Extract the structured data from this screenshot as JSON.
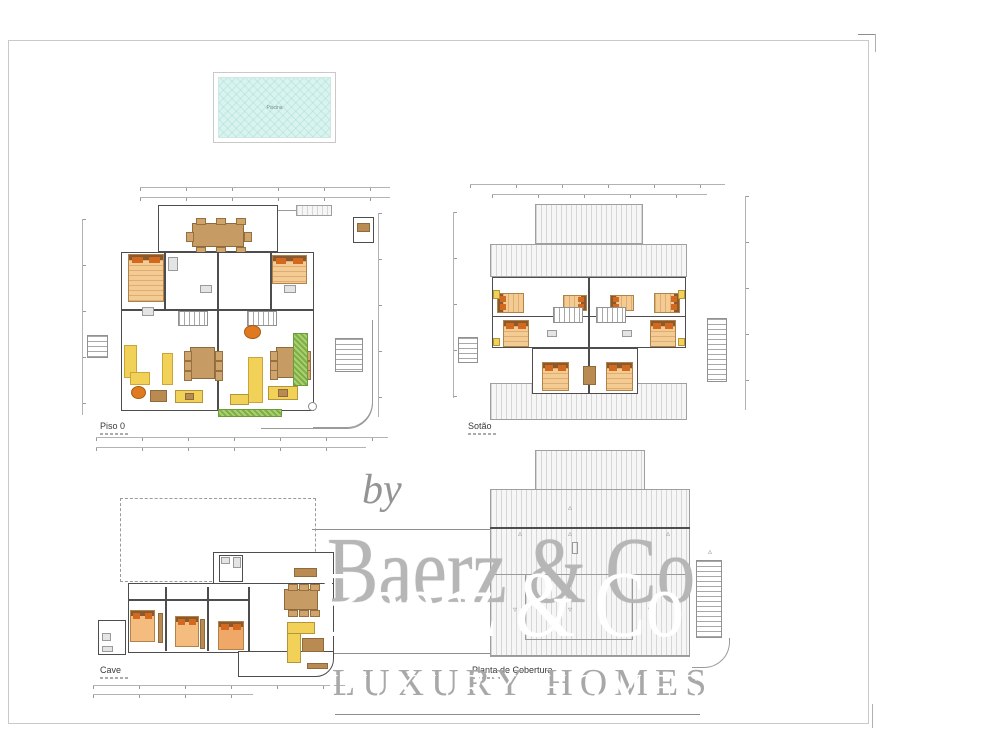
{
  "watermark": {
    "by": "by",
    "brand": "Baerz & Co",
    "tagline": "LUXURY HOMES"
  },
  "pool": {
    "label": "Piscina",
    "water_color": "#d9f3ef"
  },
  "colors": {
    "wall": "#4d4d4d",
    "dim": "#b3b3b3",
    "bed": "#f4cb92",
    "pillow": "#d2691e",
    "sofa": "#f2d159",
    "wood": "#c79c64",
    "hedge": "#8ab54f",
    "roof_hatch": "#d6d6d6"
  },
  "plans": [
    {
      "id": "piso0",
      "label": "Piso 0",
      "x": 80,
      "y": 183,
      "w": 312,
      "h": 276,
      "lx": 20,
      "ly": 238,
      "items": [
        [
          "dim-h",
          60,
          4,
          250,
          4
        ],
        [
          "dim-h",
          60,
          14,
          250,
          4
        ],
        [
          "dim-v",
          2,
          36,
          4,
          196
        ],
        [
          "dim-v",
          298,
          30,
          4,
          204
        ],
        [
          "dim-h",
          16,
          254,
          292,
          4
        ],
        [
          "dim-h",
          16,
          264,
          270,
          4
        ],
        [
          "wall-rect",
          78,
          22,
          120,
          47
        ],
        [
          "table",
          112,
          40,
          52,
          24,
          {
            "ch": 8
          }
        ],
        [
          "gray-line",
          198,
          27,
          52,
          1
        ],
        [
          "roof",
          216,
          22,
          36,
          11
        ],
        [
          "wall-rect",
          273,
          34,
          21,
          26
        ],
        [
          "wood",
          277,
          40,
          13,
          9
        ],
        [
          "wall-rect",
          41,
          69,
          193,
          159
        ],
        [
          "wall-line",
          137,
          69,
          2,
          159
        ],
        [
          "wall-line",
          41,
          126,
          96,
          2
        ],
        [
          "wall-line",
          139,
          126,
          95,
          2
        ],
        [
          "wall-line",
          84,
          69,
          2,
          57
        ],
        [
          "wall-line",
          190,
          69,
          2,
          57
        ],
        [
          "stair-h",
          98,
          128,
          30,
          15
        ],
        [
          "stair-h",
          167,
          128,
          30,
          15
        ],
        [
          "bed",
          48,
          71,
          36,
          48
        ],
        [
          "bed",
          192,
          72,
          35,
          29
        ],
        [
          "fix",
          88,
          74,
          10,
          14
        ],
        [
          "fix",
          62,
          124,
          12,
          9
        ],
        [
          "fix",
          120,
          102,
          12,
          8
        ],
        [
          "fix",
          204,
          102,
          12,
          8
        ],
        [
          "sofa",
          44,
          162,
          13,
          33
        ],
        [
          "sofa",
          50,
          189,
          20,
          13
        ],
        [
          "sofa",
          82,
          170,
          11,
          32
        ],
        [
          "round",
          51,
          203,
          15,
          13
        ],
        [
          "table",
          110,
          164,
          25,
          32,
          {
            "ch": 6
          }
        ],
        [
          "wood",
          70,
          207,
          17,
          12
        ],
        [
          "counter",
          95,
          207,
          28,
          13
        ],
        [
          "wood",
          105,
          210,
          9,
          7
        ],
        [
          "round",
          164,
          142,
          17,
          14
        ],
        [
          "table",
          196,
          164,
          27,
          31,
          {
            "ch": 6
          }
        ],
        [
          "sofa",
          168,
          174,
          15,
          46
        ],
        [
          "counter",
          150,
          211,
          19,
          11
        ],
        [
          "counter",
          188,
          203,
          30,
          14
        ],
        [
          "wood",
          198,
          206,
          10,
          8
        ],
        [
          "hedge",
          213,
          150,
          15,
          53
        ],
        [
          "hedge",
          138,
          226,
          64,
          8
        ],
        [
          "stair-v",
          255,
          155,
          28,
          34
        ],
        [
          "stair-v",
          7,
          152,
          21,
          23
        ],
        [
          "outline-rbr",
          233,
          137,
          60,
          108
        ],
        [
          "outline-rbr",
          181,
          218,
          112,
          28
        ],
        [
          "circ",
          228,
          219,
          9,
          9
        ]
      ]
    },
    {
      "id": "sotao",
      "label": "Sotão",
      "x": 452,
      "y": 178,
      "w": 300,
      "h": 268,
      "lx": 16,
      "ly": 243,
      "items": [
        [
          "dim-h",
          18,
          6,
          255,
          4
        ],
        [
          "dim-h",
          40,
          16,
          215,
          4
        ],
        [
          "dim-v",
          293,
          18,
          4,
          214
        ],
        [
          "dim-v",
          1,
          34,
          4,
          186
        ],
        [
          "roof",
          83,
          26,
          108,
          40
        ],
        [
          "roof",
          38,
          66,
          197,
          33
        ],
        [
          "roof",
          38,
          205,
          197,
          37
        ],
        [
          "wall-rect",
          40,
          99,
          194,
          71
        ],
        [
          "wall-rect",
          80,
          170,
          106,
          46
        ],
        [
          "wall-line",
          136,
          99,
          2,
          117
        ],
        [
          "wall-line",
          40,
          138,
          194,
          1
        ],
        [
          "bed",
          45,
          115,
          27,
          20,
          {
            "dir": "h"
          }
        ],
        [
          "bed",
          111,
          117,
          24,
          16,
          {
            "dir": "h",
            "hb": "r"
          }
        ],
        [
          "bed",
          158,
          117,
          24,
          16,
          {
            "dir": "h"
          }
        ],
        [
          "bed",
          202,
          115,
          26,
          20,
          {
            "dir": "h",
            "hb": "r"
          }
        ],
        [
          "bed",
          51,
          142,
          26,
          27
        ],
        [
          "bed",
          198,
          142,
          26,
          27
        ],
        [
          "bed",
          90,
          184,
          27,
          29
        ],
        [
          "bed",
          154,
          184,
          27,
          29
        ],
        [
          "wood",
          131,
          188,
          13,
          19
        ],
        [
          "stair-h",
          101,
          129,
          30,
          16
        ],
        [
          "stair-h",
          144,
          129,
          30,
          16
        ],
        [
          "fix",
          95,
          152,
          10,
          7
        ],
        [
          "fix",
          170,
          152,
          10,
          7
        ],
        [
          "counter",
          41,
          112,
          7,
          9
        ],
        [
          "counter",
          226,
          112,
          7,
          9
        ],
        [
          "counter",
          41,
          160,
          7,
          8
        ],
        [
          "counter",
          226,
          160,
          7,
          8
        ],
        [
          "stair-v",
          6,
          159,
          20,
          26
        ],
        [
          "stair-v",
          255,
          140,
          20,
          64
        ]
      ]
    },
    {
      "id": "cave",
      "label": "Cave",
      "x": 88,
      "y": 495,
      "w": 272,
      "h": 210,
      "lx": 12,
      "ly": 170,
      "items": [
        [
          "dash-rect",
          32,
          3,
          196,
          84
        ],
        [
          "wall-rect",
          125,
          57,
          121,
          35
        ],
        [
          "wall-rect",
          40,
          88,
          206,
          70
        ],
        [
          "wall-rbr",
          150,
          156,
          96,
          26
        ],
        [
          "wall-rect",
          10,
          125,
          28,
          35
        ],
        [
          "wall-line",
          77,
          92,
          2,
          64
        ],
        [
          "wall-line",
          119,
          92,
          2,
          64
        ],
        [
          "wall-line",
          160,
          92,
          2,
          64
        ],
        [
          "wall-line",
          40,
          104,
          120,
          2
        ],
        [
          "bed",
          42,
          115,
          25,
          32,
          {
            "c": "#f5bc80"
          }
        ],
        [
          "bed",
          87,
          121,
          24,
          31,
          {
            "c": "#f5bc80"
          }
        ],
        [
          "bed",
          130,
          126,
          26,
          29,
          {
            "c": "#f0a868"
          }
        ],
        [
          "wood",
          70,
          118,
          5,
          30
        ],
        [
          "wood",
          112,
          124,
          5,
          30
        ],
        [
          "table",
          196,
          94,
          34,
          21,
          {
            "ch": 6
          }
        ],
        [
          "counter",
          199,
          127,
          14,
          41
        ],
        [
          "counter",
          199,
          127,
          28,
          12
        ],
        [
          "wood",
          214,
          143,
          22,
          14
        ],
        [
          "wood",
          219,
          168,
          21,
          6
        ],
        [
          "wood",
          206,
          73,
          23,
          9
        ],
        [
          "wall-rect",
          131,
          60,
          24,
          27
        ],
        [
          "fix",
          133,
          62,
          9,
          7
        ],
        [
          "fix",
          145,
          62,
          8,
          11
        ],
        [
          "fix",
          14,
          138,
          9,
          8
        ],
        [
          "fix",
          14,
          151,
          11,
          6
        ],
        [
          "dim-h",
          5,
          190,
          252,
          4
        ],
        [
          "dim-h",
          5,
          199,
          160,
          4
        ]
      ]
    },
    {
      "id": "cobertura",
      "label": "Planta de Cobertura",
      "x": 420,
      "y": 446,
      "w": 312,
      "h": 252,
      "lx": 52,
      "ly": 219,
      "items": [
        [
          "roof",
          115,
          4,
          110,
          40
        ],
        [
          "roof",
          70,
          43,
          200,
          168
        ],
        [
          "wall-line",
          70,
          81,
          200,
          2
        ],
        [
          "gray-line",
          70,
          128,
          200,
          1
        ],
        [
          "outline",
          105,
          128,
          108,
          66
        ],
        [
          "gray-line",
          70,
          209,
          200,
          1
        ],
        [
          "stair-v",
          276,
          114,
          26,
          78
        ],
        [
          "outline-rbr",
          272,
          192,
          38,
          30
        ],
        [
          "outline",
          152,
          96,
          6,
          12
        ],
        [
          "tri",
          148,
          58,
          10,
          10
        ],
        [
          "tri",
          98,
          84,
          10,
          10
        ],
        [
          "tri",
          148,
          84,
          10,
          10
        ],
        [
          "tri",
          246,
          84,
          10,
          10
        ],
        [
          "tri",
          288,
          102,
          10,
          10
        ],
        [
          "tri",
          93,
          160,
          10,
          10,
          {
            "g": "▿"
          }
        ],
        [
          "tri",
          148,
          160,
          10,
          10,
          {
            "g": "▿"
          }
        ],
        [
          "tri",
          228,
          160,
          10,
          10,
          {
            "g": "▿"
          }
        ]
      ]
    }
  ],
  "extras": {
    "hlines": [
      [
        312,
        529,
        377
      ],
      [
        310,
        653,
        380
      ],
      [
        335,
        714,
        365
      ],
      [
        858,
        34,
        18
      ]
    ],
    "vlines": [
      [
        875,
        34,
        18
      ],
      [
        872,
        704,
        24
      ]
    ]
  }
}
